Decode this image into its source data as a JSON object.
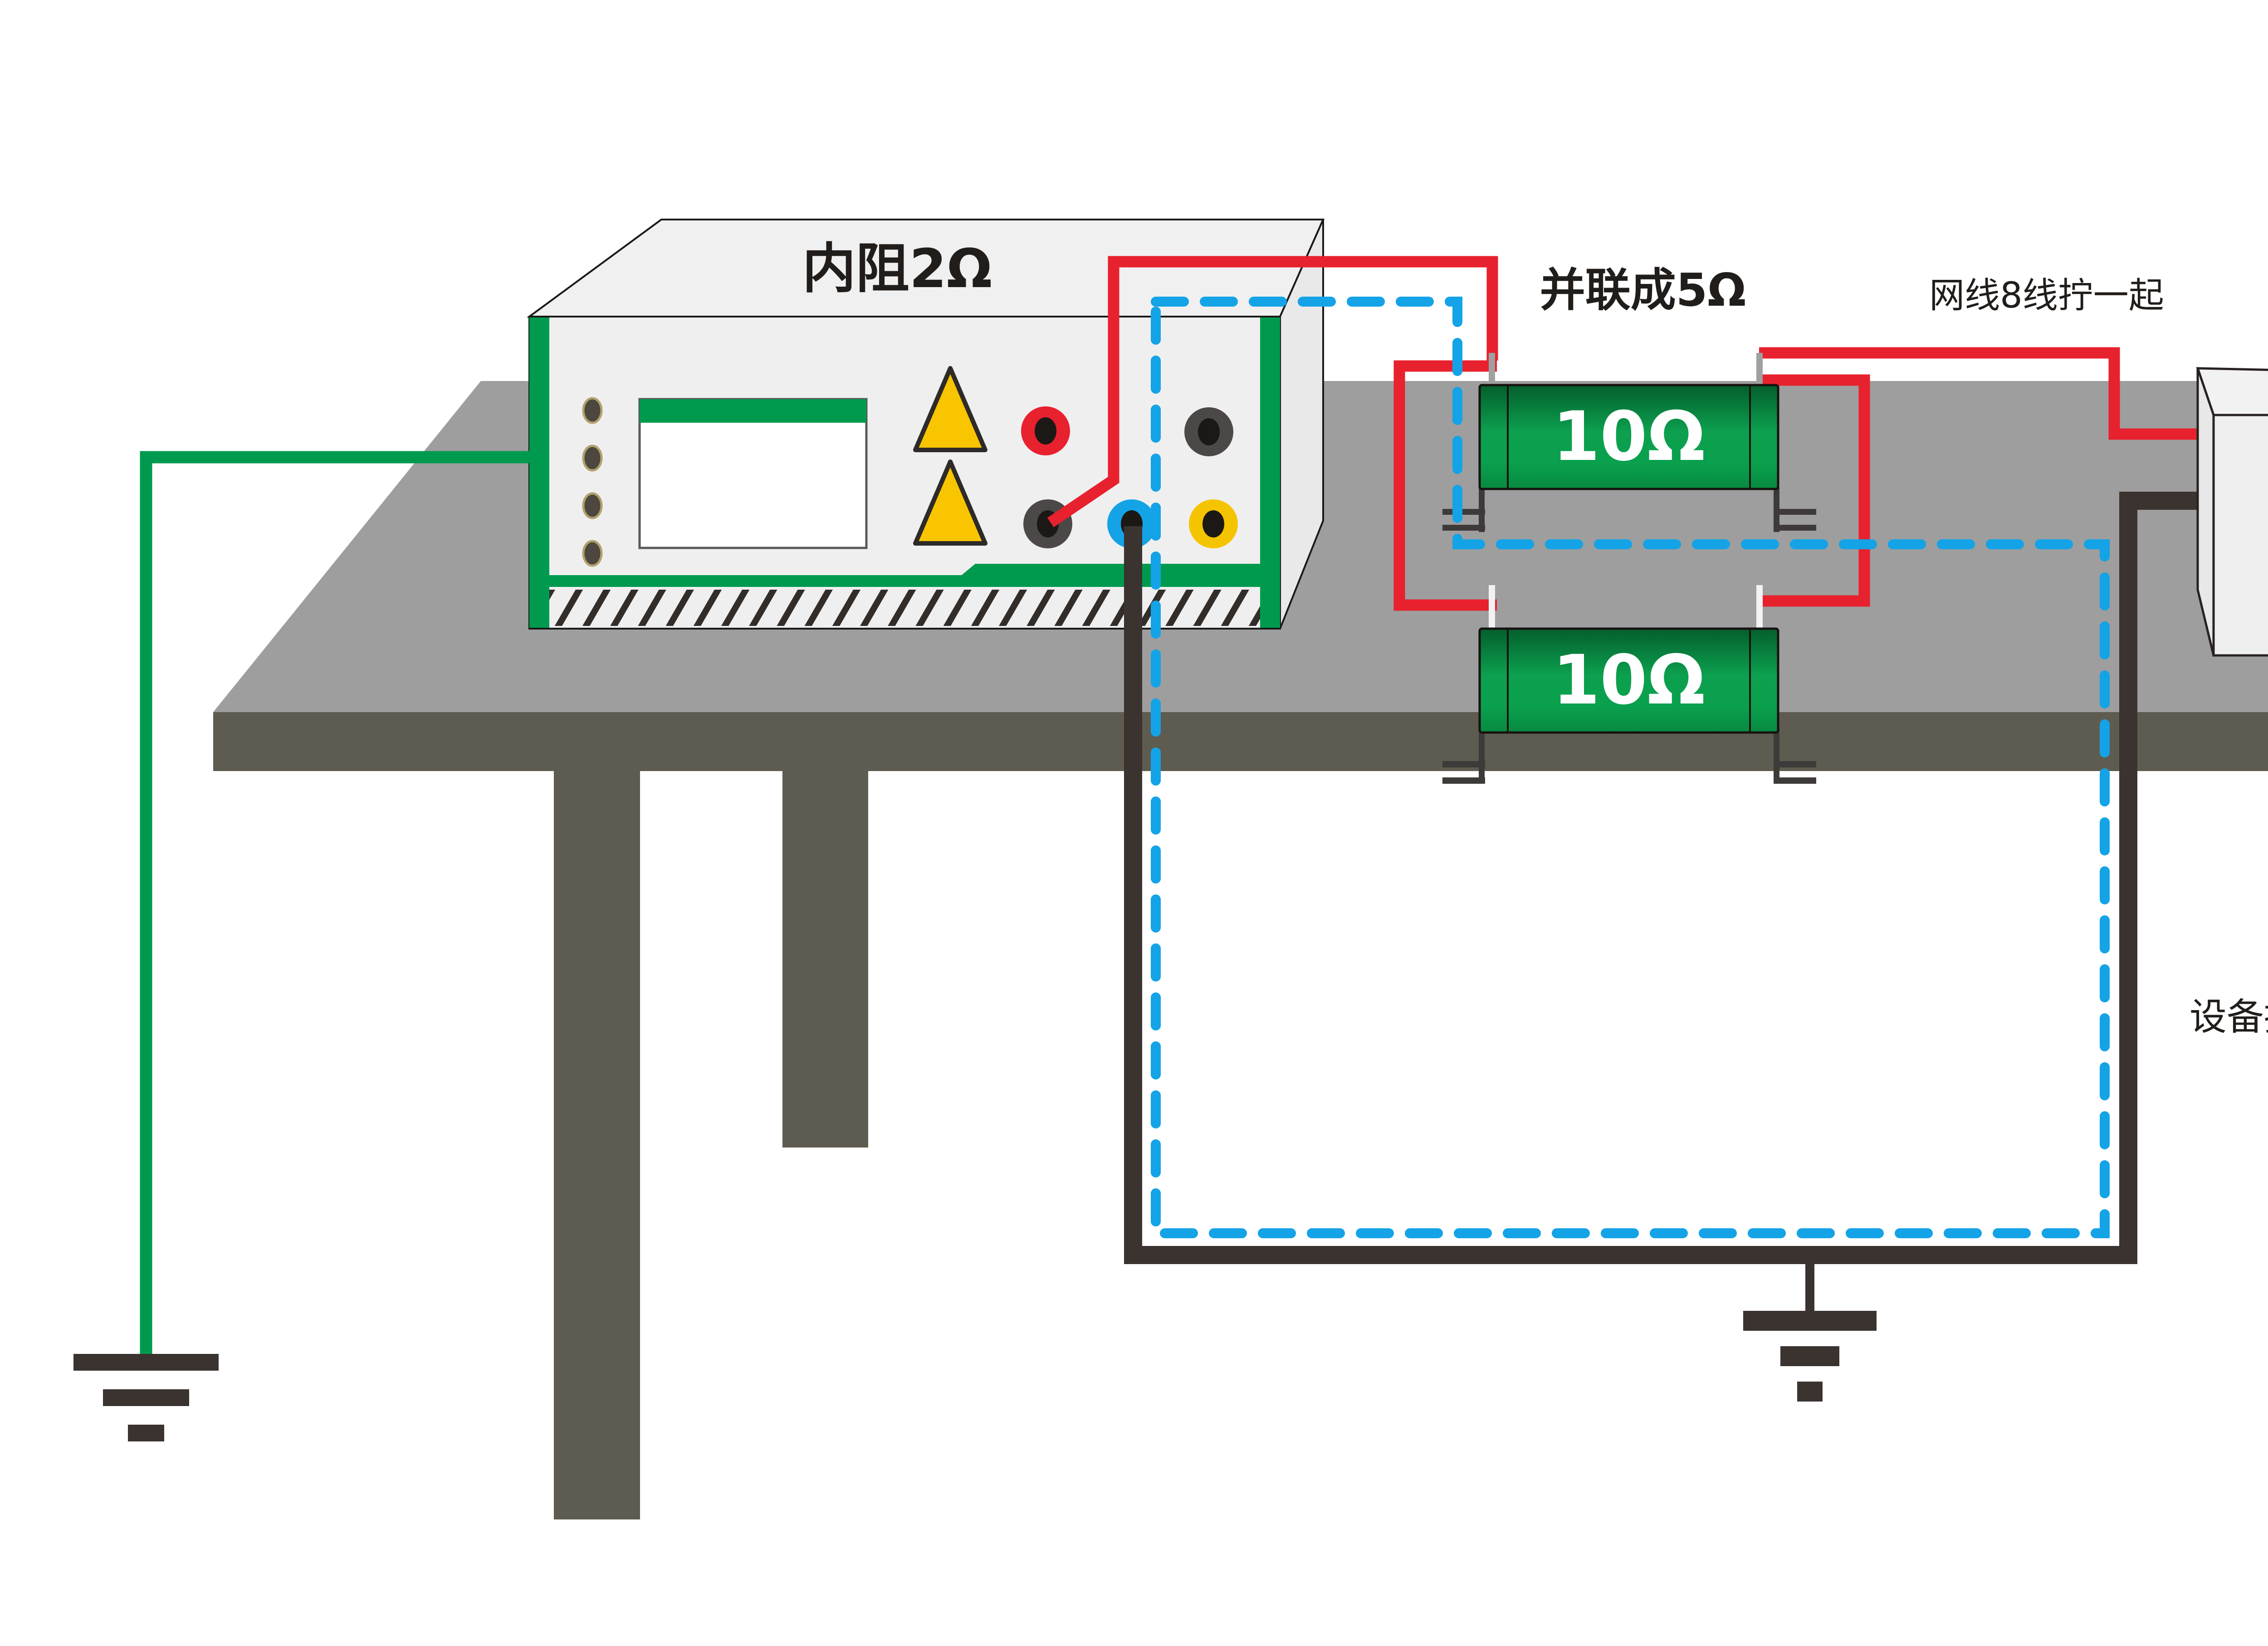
{
  "diagram": {
    "type": "test-setup-illustration",
    "instrument": {
      "label": "内阻2Ω",
      "terminals": [
        {
          "name": "red-terminal",
          "color": "#e8212e"
        },
        {
          "name": "gray-terminal-top",
          "color": "#4c4847"
        },
        {
          "name": "gray-terminal-bottom",
          "color": "#4c4847"
        },
        {
          "name": "blue-terminal",
          "color": "#14a3e6"
        },
        {
          "name": "yellow-terminal",
          "color": "#f5c400"
        }
      ]
    },
    "resistors": {
      "parallel_note": "并联成5Ω",
      "items": [
        {
          "value": "10Ω"
        },
        {
          "value": "10Ω"
        }
      ]
    },
    "cable_note": "网线8线拧一起",
    "eut": {
      "line1": "EUT",
      "line2": "RJ45"
    },
    "ground_note": "设备接地端",
    "adapter": {
      "label": "AC/DC",
      "note": "通过AC电源到地"
    },
    "mains": {
      "label": "市电"
    },
    "colors": {
      "wire_green": "#009a4e",
      "wire_red": "#e8212e",
      "wire_blue": "#14a3e6",
      "wire_black": "#3a3330",
      "table_top": "#9e9e9e",
      "table_frame": "#5e5c50",
      "panel": "#efeff0",
      "resistor_green": "#0ca04f",
      "warning_yellow": "#f8c500",
      "laptop_screen": "#0ba2e8"
    }
  }
}
